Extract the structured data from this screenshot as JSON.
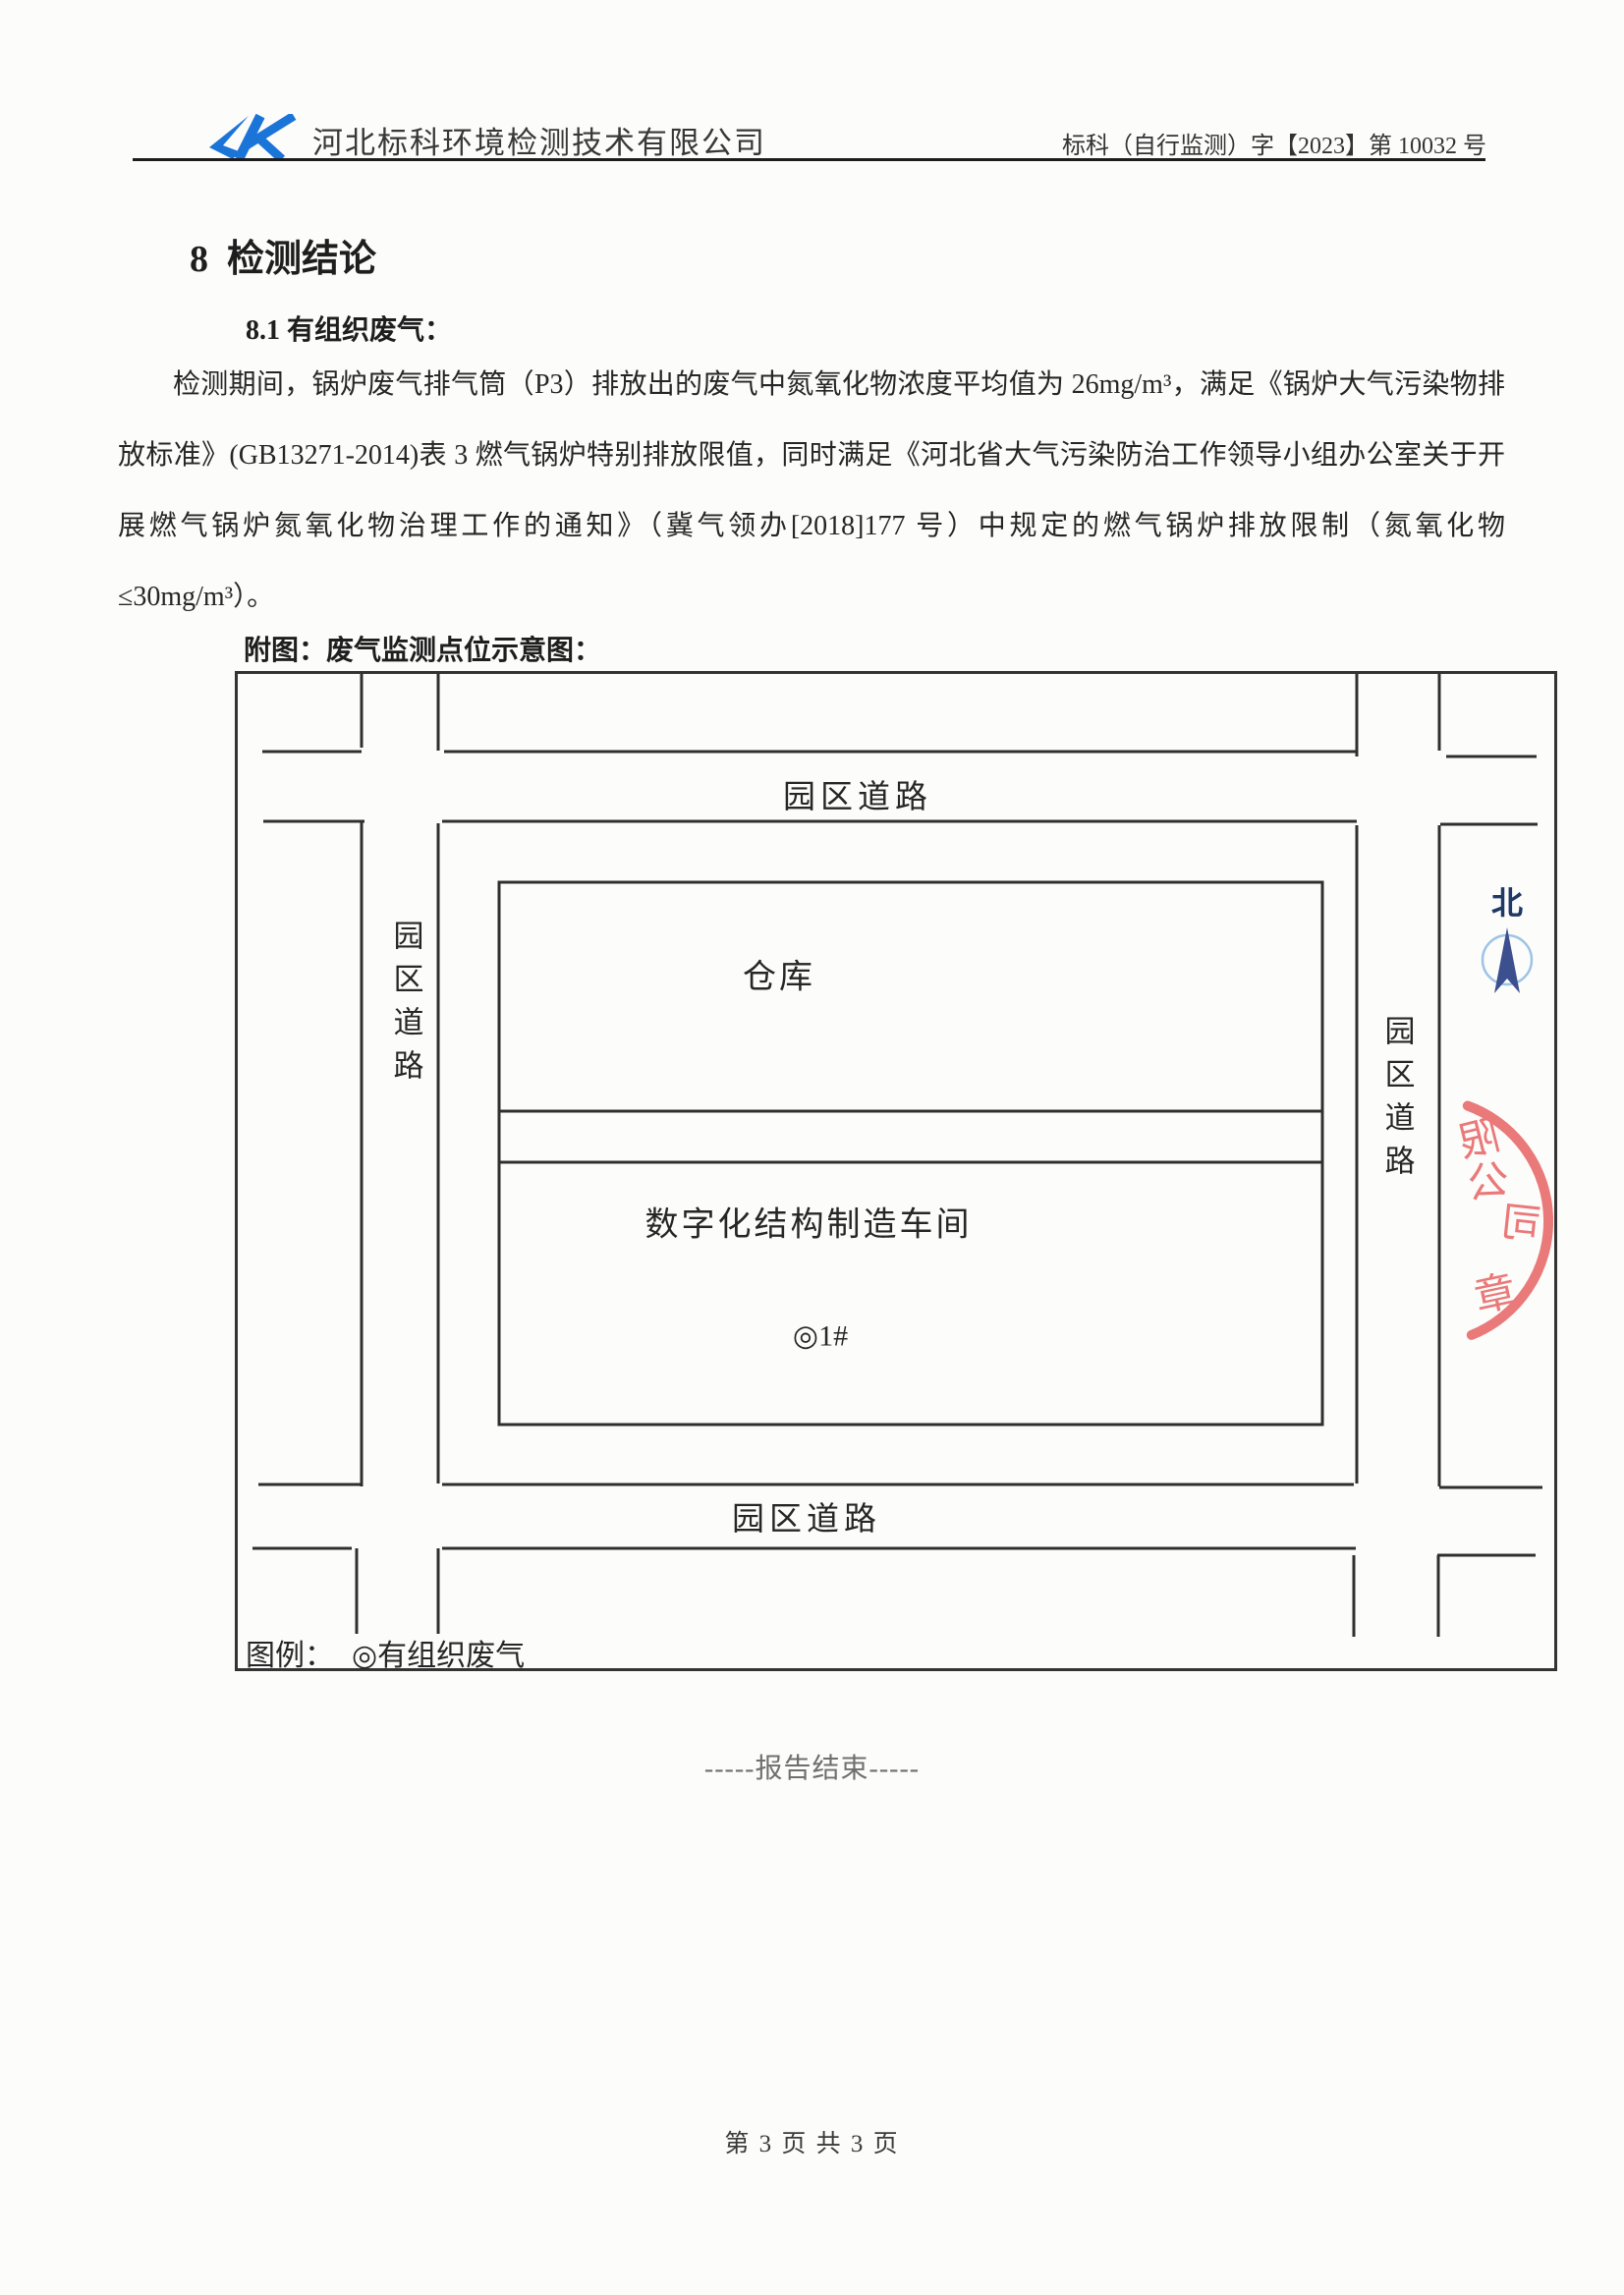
{
  "header": {
    "company": "河北标科环境检测技术有限公司",
    "doc_number": "标科（自行监测）字【2023】第 10032 号"
  },
  "title": "8  检测结论",
  "section": {
    "heading": "8.1 有组织废气：",
    "paragraph": "检测期间，锅炉废气排气筒（P3）排放出的废气中氮氧化物浓度平均值为 26mg/m³，满足《锅炉大气污染物排放标准》(GB13271-2014)表 3 燃气锅炉特别排放限值，同时满足《河北省大气污染防治工作领导小组办公室关于开展燃气锅炉氮氧化物治理工作的通知》（冀气领办[2018]177 号）中规定的燃气锅炉排放限制（氮氧化物≤30mg/m³）。",
    "figure_caption": "附图：废气监测点位示意图："
  },
  "diagram": {
    "roads": {
      "top": "园区道路",
      "bottom": "园区道路",
      "left": "园区道路",
      "right": "园区道路"
    },
    "buildings": {
      "warehouse": "仓库",
      "workshop": "数字化结构制造车间"
    },
    "monitor_point": "◎1#",
    "north": "北",
    "legend": {
      "label": "图例：",
      "item": "◎有组织废气"
    },
    "stamp": {
      "chars": [
        "限",
        "公",
        "司",
        "章"
      ]
    }
  },
  "end_text": "-----报告结束-----",
  "footer": "第 3 页 共 3 页",
  "colors": {
    "logo_blue": "#1b74d8",
    "north_navy": "#1f3864",
    "arrow_blue": "#3c4f8f",
    "compass_ring": "#9dc3e6",
    "stamp_red": "#e86868",
    "ink": "#2f2f2f"
  }
}
